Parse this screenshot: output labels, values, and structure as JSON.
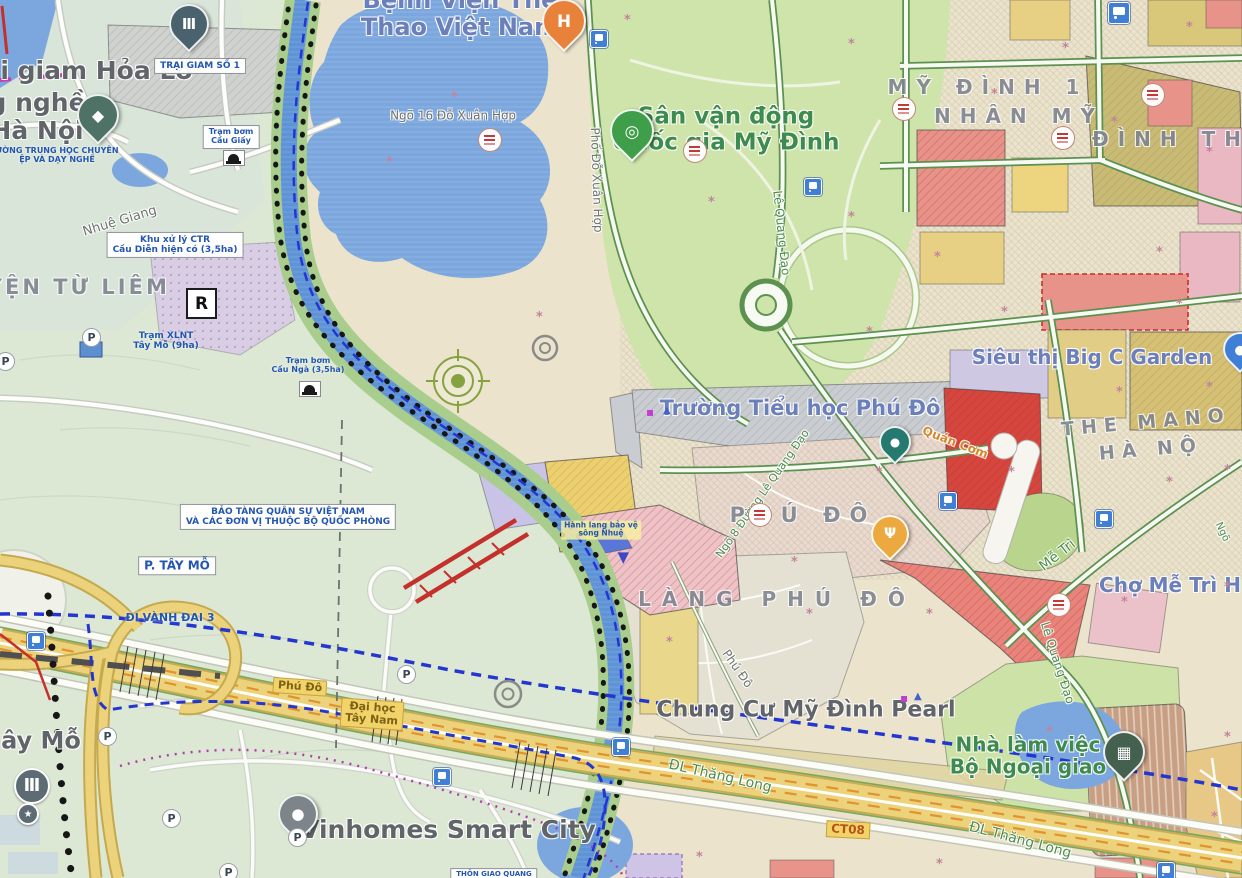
{
  "colors": {
    "water": "#7ca7de",
    "river": "#5e93d6",
    "park_green": "#cfe4ab",
    "west_green": "#dce8d4",
    "planning_beige": "#ebe3cc",
    "village_beige": "#e5e1d2",
    "highway_yellow": "#ecd27b",
    "highway_orange": "#e0932f",
    "road_green_edge": "#5d9150",
    "boundary_blue": "#2336cf",
    "boundary_magenta": "#b03fae",
    "planned_road_red": "#c4302c",
    "poi_blue": "#6b80ba",
    "poi_green": "#3d8b4e",
    "poi_gray": "#616569",
    "district_gray": "#7d838d",
    "plan_text_blue": "#2456b0",
    "transit_blue": "#3f7fd6"
  },
  "icons": {
    "parking_letter": "P",
    "flower_glyph": "*"
  },
  "map": {
    "labels": [
      {
        "name": "poi-label-trai-giam-hoa-lo",
        "text": "ại giam Hỏa Lò",
        "x": 88,
        "y": 71,
        "cls": "poiGray",
        "fs": 25,
        "interactable": true
      },
      {
        "name": "plan-label-trai-giam-so-1",
        "text": "TRẠI GIAM SỐ 1",
        "x": 200,
        "y": 66,
        "cls": "planBox",
        "fs": 9,
        "interactable": false
      },
      {
        "name": "poi-label-truong-nghe-ha-noi",
        "text": "g nghề\nHà Nội",
        "x": 37,
        "y": 117,
        "cls": "poiGray",
        "fs": 25,
        "interactable": true
      },
      {
        "name": "plan-label-truong-thcn-day-nghe",
        "text": "ƯỜNG TRUNG HỌC CHUYÊN\nỆP VÀ DẠY NGHỀ",
        "x": 57,
        "y": 156,
        "cls": "planText",
        "fs": 8,
        "interactable": false
      },
      {
        "name": "poi-label-benh-vien-the-thao",
        "text": "Bệnh Viện Thể\nThao Việt Nam",
        "x": 460,
        "y": 14,
        "cls": "poiBlue",
        "fs": 24,
        "interactable": true
      },
      {
        "name": "road-label-ngo-16-do-xuan-hop",
        "text": "Ngõ 16 Đỗ Xuân Hợp",
        "x": 453,
        "y": 116,
        "cls": "roadGray",
        "fs": 12,
        "interactable": false
      },
      {
        "name": "road-label-pho-do-xuan-hop",
        "text": "Phố Đỗ Xuân Hợp",
        "x": 596,
        "y": 180,
        "cls": "roadGray",
        "fs": 12,
        "rot": 88,
        "interactable": false
      },
      {
        "name": "poi-label-san-van-dong-my-dinh",
        "text": "Sân vận động\nQuốc gia Mỹ Đình",
        "x": 726,
        "y": 130,
        "cls": "poiGreen",
        "fs": 23,
        "interactable": true
      },
      {
        "name": "road-label-le-quang-dao-1",
        "text": "Lê Quang Đạo",
        "x": 781,
        "y": 233,
        "cls": "roadGreen",
        "fs": 12,
        "rot": 84,
        "interactable": false
      },
      {
        "name": "district-label-my-dinh-1",
        "text": "MỸ ĐÌNH 1",
        "x": 988,
        "y": 87,
        "cls": "district",
        "fs": 20,
        "ls": 9,
        "interactable": false
      },
      {
        "name": "district-label-nhan-my",
        "text": "NHÂN MỸ",
        "x": 1019,
        "y": 116,
        "cls": "district",
        "fs": 20,
        "ls": 9,
        "interactable": false
      },
      {
        "name": "district-label-dinh-th",
        "text": "ĐÌNH TH",
        "x": 1171,
        "y": 139,
        "cls": "district",
        "fs": 20,
        "ls": 9,
        "interactable": false
      },
      {
        "name": "poi-label-big-c-garden",
        "text": "Siêu thị Big C Garden",
        "x": 1092,
        "y": 357,
        "cls": "poiBlue",
        "fs": 20,
        "interactable": true
      },
      {
        "name": "district-label-the-mano",
        "text": "THE MANO",
        "x": 1146,
        "y": 423,
        "cls": "district",
        "fs": 19,
        "ls": 7,
        "rot": -5,
        "interactable": false
      },
      {
        "name": "district-label-ha-no",
        "text": "HÀ NỘ",
        "x": 1151,
        "y": 450,
        "cls": "district",
        "fs": 19,
        "ls": 7,
        "rot": -5,
        "interactable": false
      },
      {
        "name": "poi-label-truong-tieu-hoc-phu-do",
        "text": "Trường Tiểu học Phú Đô",
        "x": 800,
        "y": 409,
        "cls": "poiBlue",
        "fs": 21,
        "interactable": true
      },
      {
        "name": "poi-label-quan-com",
        "text": "Quán Cơm",
        "x": 955,
        "y": 443,
        "cls": "orangeText",
        "fs": 12,
        "rot": 21,
        "interactable": true
      },
      {
        "name": "district-label-phu-do",
        "text": "PHÚ ĐÔ",
        "x": 803,
        "y": 516,
        "cls": "district",
        "fs": 21,
        "ls": 9,
        "interactable": false
      },
      {
        "name": "road-label-ngo-8-le-quang-dao",
        "text": "Ngõ 8 Đường Lê Quang Đạo",
        "x": 763,
        "y": 494,
        "cls": "roadGreen",
        "fs": 11,
        "rot": -55,
        "interactable": false
      },
      {
        "name": "district-label-lang-phu-do",
        "text": "LÀNG PHÚ ĐÔ",
        "x": 777,
        "y": 599,
        "cls": "district",
        "fs": 20,
        "ls": 11,
        "interactable": false
      },
      {
        "name": "road-label-phu-do-street",
        "text": "Phú Đô",
        "x": 737,
        "y": 669,
        "cls": "roadGray",
        "fs": 12,
        "rot": 55,
        "interactable": false
      },
      {
        "name": "poi-label-chung-cu-my-dinh-pearl",
        "text": "Chung Cư Mỹ Đình Pearl",
        "x": 806,
        "y": 711,
        "cls": "poiGray",
        "fs": 22,
        "interactable": true
      },
      {
        "name": "road-label-dl-thang-long-1",
        "text": "ĐL Thăng Long",
        "x": 720,
        "y": 777,
        "cls": "roadGreen",
        "fs": 14,
        "rot": 13,
        "interactable": false
      },
      {
        "name": "road-label-ct08",
        "text": "CT08",
        "x": 848,
        "y": 830,
        "cls": "ct08",
        "fs": 12,
        "rot": 3,
        "interactable": false
      },
      {
        "name": "road-label-dl-thang-long-2",
        "text": "ĐL Thăng Long",
        "x": 1020,
        "y": 841,
        "cls": "roadGreen",
        "fs": 14,
        "rot": 15,
        "interactable": false
      },
      {
        "name": "poi-label-nha-lam-viec-bo-ngoai-giao",
        "text": "Nhà làm việc\nBộ Ngoại giao",
        "x": 1028,
        "y": 756,
        "cls": "poiGreen",
        "fs": 20,
        "interactable": true
      },
      {
        "name": "road-label-me-tri",
        "text": "Mễ Trì",
        "x": 1058,
        "y": 556,
        "cls": "roadGreen",
        "fs": 14,
        "rot": -38,
        "interactable": false
      },
      {
        "name": "poi-label-cho-me-tri",
        "text": "Chợ Mễ Trì H",
        "x": 1170,
        "y": 585,
        "cls": "poiBlue",
        "fs": 20,
        "interactable": true
      },
      {
        "name": "road-label-le-quang-dao-2",
        "text": "Lê Quang Đạo",
        "x": 1057,
        "y": 663,
        "cls": "roadGreen",
        "fs": 12,
        "rot": 72,
        "interactable": false
      },
      {
        "name": "road-label-ngo",
        "text": "Ngõ",
        "x": 1222,
        "y": 532,
        "cls": "roadGreen",
        "fs": 10,
        "rot": 65,
        "interactable": false
      },
      {
        "name": "district-label-huyen-tu-liem",
        "text": "HUYỆN TỪ LIÊM",
        "x": 58,
        "y": 288,
        "cls": "district",
        "fs": 21,
        "ls": 3,
        "interactable": false
      },
      {
        "name": "water-label-nhue-giang",
        "text": "Nhuệ Giang",
        "x": 120,
        "y": 222,
        "cls": "roadGray",
        "fs": 13,
        "rot": -17,
        "interactable": false
      },
      {
        "name": "plan-label-khu-xu-ly-ctr",
        "text": "Khu xử lý CTR\nCầu Diễn hiện có (3,5ha)",
        "x": 175,
        "y": 245,
        "cls": "planBox",
        "fs": 9,
        "interactable": false
      },
      {
        "name": "plan-label-tram-xlnt",
        "text": "Trạm XLNT\nTây Mỗ (9ha)",
        "x": 166,
        "y": 341,
        "cls": "planText",
        "fs": 9,
        "interactable": false
      },
      {
        "name": "plan-label-tram-bom-cau-giay",
        "text": "Trạm bơm\nCầu Giấy",
        "x": 231,
        "y": 137,
        "cls": "planBox",
        "fs": 8,
        "interactable": false
      },
      {
        "name": "plan-label-cau-nga",
        "text": "Trạm bơm\nCầu Ngà (3,5ha)",
        "x": 308,
        "y": 366,
        "cls": "planText",
        "fs": 8,
        "interactable": false
      },
      {
        "name": "plan-label-bao-tang-quan-su",
        "text": "BẢO TÀNG QUÂN SỰ VIỆT NAM\nVÀ CÁC ĐƠN VỊ THUỘC BỘ QUỐC PHÒNG",
        "x": 288,
        "y": 517,
        "cls": "planBox",
        "fs": 9,
        "interactable": false
      },
      {
        "name": "plan-label-p-tay-mo",
        "text": "P. TÂY MỖ",
        "x": 177,
        "y": 566,
        "cls": "planBox",
        "fs": 12,
        "interactable": false
      },
      {
        "name": "plan-label-di-vanh-dai-3",
        "text": "ĐI VÀNH ĐAI 3",
        "x": 170,
        "y": 618,
        "cls": "planText",
        "fs": 11,
        "interactable": false
      },
      {
        "name": "road-label-phu-do-highway",
        "text": "Phú Đô",
        "x": 300,
        "y": 687,
        "cls": "hwyBox",
        "fs": 11,
        "rot": 4,
        "interactable": false
      },
      {
        "name": "road-label-dai-hoc-tay-nam",
        "text": "Đại học\nTây Nam",
        "x": 372,
        "y": 714,
        "cls": "hwyBox",
        "fs": 11,
        "rot": 4,
        "interactable": false
      },
      {
        "name": "poi-label-tay-mo",
        "text": "ây Mỗ",
        "x": 41,
        "y": 741,
        "cls": "poiGray",
        "fs": 24,
        "interactable": true
      },
      {
        "name": "poi-label-vinhomes-smart-city",
        "text": "Vinhomes Smart City",
        "x": 448,
        "y": 830,
        "cls": "poiGray",
        "fs": 25,
        "interactable": true
      },
      {
        "name": "plan-label-thon-giao-quang",
        "text": "THÔN GIAO QUANG",
        "x": 494,
        "y": 875,
        "cls": "planBox",
        "fs": 7,
        "interactable": false
      },
      {
        "name": "plan-label-hanh-lang-song-nhue",
        "text": "Hành lang bảo vệ\nsông Nhuệ",
        "x": 601,
        "y": 530,
        "cls": "planNote",
        "fs": 7.5,
        "interactable": false
      }
    ],
    "pins": [
      {
        "name": "museum-pin-hoa-lo",
        "x": 187,
        "y": 47,
        "color": "#4a626e",
        "glyph": "Ⅲ",
        "size": 36
      },
      {
        "name": "school-pin-day-nghe",
        "x": 96,
        "y": 140,
        "color": "#4e7265",
        "glyph": "◆",
        "size": 38
      },
      {
        "name": "hospital-pin-the-thao",
        "x": 562,
        "y": 47,
        "color": "#e8823a",
        "glyph": "H",
        "size": 40
      },
      {
        "name": "stadium-pin-my-dinh",
        "x": 630,
        "y": 157,
        "color": "#3f9e4a",
        "glyph": "◎",
        "size": 40
      },
      {
        "name": "poi-pin-teal",
        "x": 893,
        "y": 460,
        "color": "#26796f",
        "glyph": "●",
        "size": 28
      },
      {
        "name": "restaurant-pin-phu-do",
        "x": 888,
        "y": 556,
        "color": "#eba93f",
        "glyph": "Ψ",
        "size": 34
      },
      {
        "name": "ministry-pin-bo-ngoai-giao",
        "x": 1122,
        "y": 777,
        "color": "#44604f",
        "glyph": "▦",
        "size": 38
      },
      {
        "name": "vinhomes-pin",
        "x": 296,
        "y": 837,
        "color": "#7d848a",
        "glyph": "●",
        "size": 36
      },
      {
        "name": "shopping-pin-big-c",
        "x": 1238,
        "y": 368,
        "color": "#3f7fd6",
        "glyph": "●",
        "size": 30
      }
    ],
    "transit_icons": [
      {
        "name": "transit-icon-do-xuan-hop",
        "x": 598,
        "y": 38
      },
      {
        "name": "transit-icon-le-quang-dao",
        "x": 812,
        "y": 186
      },
      {
        "name": "transit-icon-phu-do",
        "x": 947,
        "y": 500
      },
      {
        "name": "transit-icon-me-tri",
        "x": 1103,
        "y": 518
      },
      {
        "name": "transit-icon-thang-long-w",
        "x": 441,
        "y": 776
      },
      {
        "name": "transit-icon-vanh-dai-3",
        "x": 35,
        "y": 640
      },
      {
        "name": "transit-icon-thang-long-e",
        "x": 1165,
        "y": 870
      },
      {
        "name": "transit-icon-bridge",
        "x": 620,
        "y": 746
      },
      {
        "name": "transit-icon-my-dinh-ne",
        "x": 1118,
        "y": 12,
        "size": 20
      }
    ],
    "parking_markers": [
      {
        "name": "parking-marker-1",
        "x": 90,
        "y": 336
      },
      {
        "name": "parking-marker-2",
        "x": 4,
        "y": 360
      },
      {
        "name": "parking-marker-3",
        "x": 405,
        "y": 673
      },
      {
        "name": "parking-marker-4",
        "x": 106,
        "y": 735
      },
      {
        "name": "parking-marker-5",
        "x": 170,
        "y": 817
      },
      {
        "name": "parking-marker-6",
        "x": 296,
        "y": 836
      },
      {
        "name": "parking-marker-7",
        "x": 227,
        "y": 871
      }
    ],
    "zone_badges": [
      {
        "x": 489,
        "y": 139
      },
      {
        "x": 694,
        "y": 150
      },
      {
        "x": 903,
        "y": 108
      },
      {
        "x": 1062,
        "y": 137
      },
      {
        "x": 759,
        "y": 514
      },
      {
        "x": 1058,
        "y": 604
      },
      {
        "x": 1152,
        "y": 94
      }
    ],
    "flowers": [
      {
        "x": 628,
        "y": 18
      },
      {
        "x": 852,
        "y": 42
      },
      {
        "x": 1066,
        "y": 46
      },
      {
        "x": 1190,
        "y": 25
      },
      {
        "x": 712,
        "y": 200
      },
      {
        "x": 852,
        "y": 215
      },
      {
        "x": 995,
        "y": 92
      },
      {
        "x": 1115,
        "y": 120
      },
      {
        "x": 1210,
        "y": 150
      },
      {
        "x": 938,
        "y": 255
      },
      {
        "x": 1005,
        "y": 310
      },
      {
        "x": 1180,
        "y": 302
      },
      {
        "x": 1120,
        "y": 390
      },
      {
        "x": 1210,
        "y": 385
      },
      {
        "x": 880,
        "y": 470
      },
      {
        "x": 1012,
        "y": 470
      },
      {
        "x": 1170,
        "y": 480
      },
      {
        "x": 1228,
        "y": 468
      },
      {
        "x": 795,
        "y": 560
      },
      {
        "x": 930,
        "y": 612
      },
      {
        "x": 1125,
        "y": 600
      },
      {
        "x": 1228,
        "y": 585
      },
      {
        "x": 670,
        "y": 640
      },
      {
        "x": 810,
        "y": 612
      },
      {
        "x": 1050,
        "y": 730
      },
      {
        "x": 1228,
        "y": 735
      },
      {
        "x": 700,
        "y": 855
      },
      {
        "x": 940,
        "y": 862
      },
      {
        "x": 1215,
        "y": 815
      },
      {
        "x": 455,
        "y": 95
      },
      {
        "x": 390,
        "y": 160
      },
      {
        "x": 540,
        "y": 315
      },
      {
        "x": 870,
        "y": 330
      },
      {
        "x": 1160,
        "y": 250
      }
    ],
    "markers": [
      {
        "kind": "rbox",
        "name": "r-zone-marker",
        "t": "R",
        "x": 199,
        "y": 301
      },
      {
        "kind": "bank",
        "name": "bank-circle-marker",
        "x": 30,
        "y": 784,
        "r": 16,
        "glyph": "Ⅲ",
        "color": "#5c6b74"
      },
      {
        "kind": "star",
        "name": "star-circle-marker",
        "x": 26,
        "y": 812,
        "r": 9,
        "glyph": "★",
        "color": "#5c6b74"
      },
      {
        "kind": "bridge",
        "name": "bridge-icon-cau-giay",
        "x": 233,
        "y": 157
      },
      {
        "kind": "bridge",
        "name": "bridge-icon-cau-nga",
        "x": 309,
        "y": 388
      },
      {
        "kind": "mini",
        "name": "pearl-marker-magenta",
        "x": 906,
        "y": 698,
        "glyph": "▪",
        "color": "#c13fd0",
        "fs": 12
      },
      {
        "kind": "mini",
        "name": "pearl-marker-blue",
        "x": 919,
        "y": 697,
        "glyph": "▲",
        "color": "#3f62d0",
        "fs": 10
      },
      {
        "kind": "mini",
        "name": "school-marker-magenta",
        "x": 652,
        "y": 412,
        "glyph": "▪",
        "color": "#c13fd0",
        "fs": 12
      },
      {
        "kind": "mini",
        "name": "school-marker-blue",
        "x": 668,
        "y": 411,
        "glyph": "▲",
        "color": "#3f62d0",
        "fs": 10
      },
      {
        "kind": "mini",
        "name": "hanh-lang-triangle-icon",
        "x": 625,
        "y": 557,
        "glyph": "▼",
        "color": "#3d49c0",
        "fs": 15
      }
    ]
  }
}
